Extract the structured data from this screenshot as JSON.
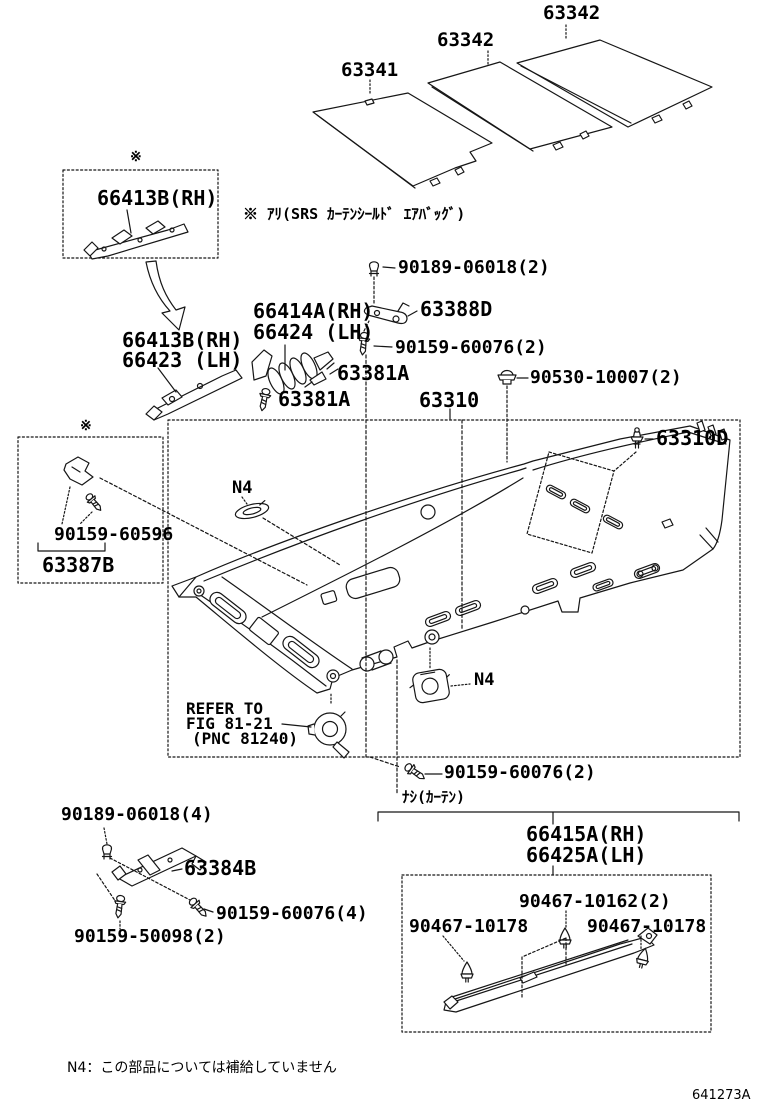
{
  "parts": {
    "silencer_front": "63341",
    "silencer_center": "63342",
    "silencer_rear": "63342",
    "bracket_box": "66413B(RH)",
    "clip2": "90189-06018(2)",
    "garnish_rh": "66414A(RH)",
    "garnish_lh": "66424 (LH)",
    "plate_63388d": "63388D",
    "screw2a": "90159-60076(2)",
    "bracket_rh": "66413B(RH)",
    "bracket_lh": "66423 (LH)",
    "bolt1": "63381A",
    "bolt2": "63381A",
    "grommet": "90530-10007(2)",
    "headlining": "63310",
    "headlining_clip": "63310D",
    "screw_60596": "90159-60596",
    "bracket_63387b": "63387B",
    "screw2b": "90159-60076(2)",
    "visor_rh": "66415A(RH)",
    "visor_lh": "66425A(LH)",
    "clip4": "90189-06018(4)",
    "bracket_63384b": "63384B",
    "screw4": "90159-60076(4)",
    "screw_50098": "90159-50098(2)",
    "retainer_center": "90467-10162(2)",
    "retainer_left": "90467-10178",
    "retainer_right": "90467-10178"
  },
  "notes": {
    "asterisk": "※",
    "airbag": "※ ｱﾘ(SRS ｶｰﾃﾝｼｰﾙﾄﾞ ｴｱﾊﾞｯｸﾞ)",
    "refer1": "REFER TO",
    "refer2": "FIG 81-21",
    "refer3": "(PNC 81240)",
    "n4": "N4",
    "no_curtain": "ﾅｼ(ｶｰﾃﾝ)",
    "footnote": "N4：この部品については補給していません",
    "doc_code": "641273A"
  }
}
